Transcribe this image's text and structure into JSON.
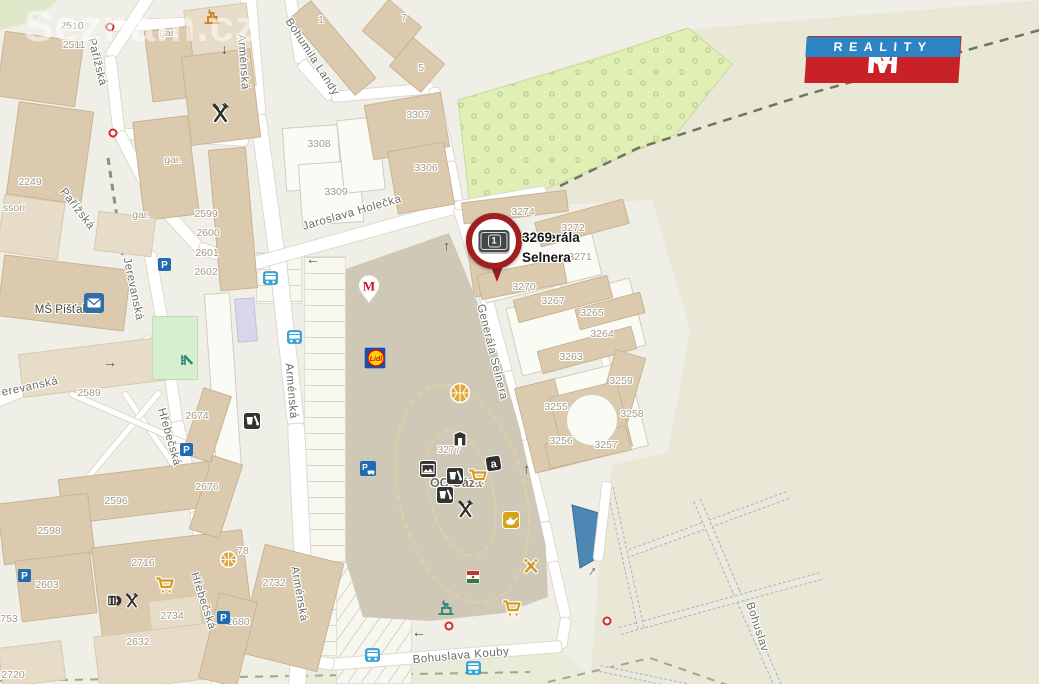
{
  "watermark": {
    "text": "Seznam.cz"
  },
  "logo": {
    "m1": "M",
    "amp": "&",
    "m2": "M",
    "reality": "REALITY"
  },
  "pin": {
    "badge": "1",
    "label_line1": "Generála Selnera",
    "label_line2": "3269"
  },
  "arrow_glyph": "→",
  "colors": {
    "base": "#f0efe7",
    "field": "#e9e8d7",
    "south_green": "#e9ecd9",
    "corner_green": "#dfe8c8",
    "orchard": "#e0efb4",
    "orchard_dot": "#b6ca8e",
    "pond": "#4d87b3",
    "accent_red": "#a11d20",
    "logo_red": "#c82127",
    "logo_blue": "#2d84c2",
    "bus_blue": "#36a7db",
    "parking_blue": "#1f6cb1",
    "cart_gold": "#d79b16"
  },
  "streets": [
    {
      "label": "Pařížská",
      "x": 97,
      "y": 62,
      "rot": 76
    },
    {
      "label": "Pařížská",
      "x": 77,
      "y": 209,
      "rot": 52
    },
    {
      "label": "Arménská",
      "x": 243,
      "y": 62,
      "rot": 86
    },
    {
      "label": "Arménská",
      "x": 291,
      "y": 391,
      "rot": 85
    },
    {
      "label": "Arménská",
      "x": 299,
      "y": 594,
      "rot": 80
    },
    {
      "label": "Bohumila Landy",
      "x": 312,
      "y": 57,
      "rot": 57
    },
    {
      "label": "Jaroslava Holečka",
      "x": 352,
      "y": 213,
      "rot": -16
    },
    {
      "label": "Jerevanská",
      "x": 133,
      "y": 289,
      "rot": 78
    },
    {
      "label": "erevanská",
      "x": 30,
      "y": 387,
      "rot": -12
    },
    {
      "label": "Hřebečská",
      "x": 169,
      "y": 437,
      "rot": 74
    },
    {
      "label": "Hřebečská",
      "x": 203,
      "y": 601,
      "rot": 72
    },
    {
      "label": "Generála Selnera",
      "x": 492,
      "y": 352,
      "rot": 76
    },
    {
      "label": "Bohuslava Kouby",
      "x": 461,
      "y": 656,
      "rot": -5
    },
    {
      "label": "Bohuslav",
      "x": 757,
      "y": 627,
      "rot": 72
    }
  ],
  "poi_labels": [
    {
      "label": "MŠ Píšťalka",
      "x": 66,
      "y": 310,
      "big": false
    },
    {
      "label": "OC Oáza",
      "x": 456,
      "y": 483,
      "big": true
    }
  ],
  "numbers": [
    {
      "t": "2510",
      "x": 72,
      "y": 26
    },
    {
      "t": "2511",
      "x": 74,
      "y": 45
    },
    {
      "t": "2249",
      "x": 30,
      "y": 182
    },
    {
      "t": "ssori",
      "x": 14,
      "y": 208
    },
    {
      "t": "gar.",
      "x": 168,
      "y": 33
    },
    {
      "t": "gar.",
      "x": 173,
      "y": 160
    },
    {
      "t": "gar.",
      "x": 141,
      "y": 215
    },
    {
      "t": "1",
      "x": 321,
      "y": 20
    },
    {
      "t": "7",
      "x": 404,
      "y": 18
    },
    {
      "t": "5",
      "x": 421,
      "y": 68
    },
    {
      "t": "3307",
      "x": 418,
      "y": 115
    },
    {
      "t": "3308",
      "x": 319,
      "y": 144
    },
    {
      "t": "3306",
      "x": 426,
      "y": 168
    },
    {
      "t": "3309",
      "x": 336,
      "y": 192
    },
    {
      "t": "2599",
      "x": 206,
      "y": 214
    },
    {
      "t": "2600",
      "x": 208,
      "y": 233
    },
    {
      "t": "2601",
      "x": 207,
      "y": 253
    },
    {
      "t": "2602",
      "x": 206,
      "y": 272
    },
    {
      "t": "3274",
      "x": 523,
      "y": 212
    },
    {
      "t": "3272",
      "x": 573,
      "y": 228
    },
    {
      "t": "3271",
      "x": 580,
      "y": 257
    },
    {
      "t": "3270",
      "x": 524,
      "y": 287
    },
    {
      "t": "3267",
      "x": 553,
      "y": 301
    },
    {
      "t": "3265",
      "x": 592,
      "y": 313
    },
    {
      "t": "3264",
      "x": 602,
      "y": 334
    },
    {
      "t": "3263",
      "x": 571,
      "y": 357
    },
    {
      "t": "3259",
      "x": 621,
      "y": 381
    },
    {
      "t": "3255",
      "x": 556,
      "y": 407
    },
    {
      "t": "3258",
      "x": 632,
      "y": 414
    },
    {
      "t": "3256",
      "x": 561,
      "y": 441
    },
    {
      "t": "3257",
      "x": 606,
      "y": 445
    },
    {
      "t": "3277",
      "x": 449,
      "y": 450
    },
    {
      "t": "2589",
      "x": 89,
      "y": 393
    },
    {
      "t": "2674",
      "x": 197,
      "y": 416
    },
    {
      "t": "2676",
      "x": 207,
      "y": 487
    },
    {
      "t": "2596",
      "x": 116,
      "y": 501
    },
    {
      "t": "2598",
      "x": 49,
      "y": 531
    },
    {
      "t": "2603",
      "x": 47,
      "y": 585
    },
    {
      "t": "2716",
      "x": 143,
      "y": 563
    },
    {
      "t": "78",
      "x": 243,
      "y": 551
    },
    {
      "t": "753",
      "x": 9,
      "y": 619
    },
    {
      "t": "2734",
      "x": 172,
      "y": 616
    },
    {
      "t": "2680",
      "x": 238,
      "y": 622
    },
    {
      "t": "2732",
      "x": 274,
      "y": 583
    },
    {
      "t": "2720",
      "x": 13,
      "y": 675
    },
    {
      "t": "2632",
      "x": 138,
      "y": 642
    }
  ],
  "roads": [
    [
      108,
      26,
      252,
      20,
      10
    ],
    [
      112,
      133,
      248,
      141,
      10
    ],
    [
      150,
      -6,
      110,
      56,
      11
    ],
    [
      110,
      56,
      119,
      132,
      11
    ],
    [
      119,
      132,
      152,
      196,
      11
    ],
    [
      152,
      196,
      199,
      247,
      11
    ],
    [
      199,
      247,
      258,
      268,
      11
    ],
    [
      248,
      -6,
      258,
      115,
      15
    ],
    [
      258,
      115,
      278,
      262,
      15
    ],
    [
      278,
      262,
      296,
      424,
      16
    ],
    [
      296,
      424,
      303,
      565,
      16
    ],
    [
      303,
      565,
      297,
      690,
      16
    ],
    [
      150,
      252,
      164,
      332,
      11
    ],
    [
      164,
      332,
      177,
      422,
      11
    ],
    [
      152,
      340,
      -4,
      402,
      10
    ],
    [
      177,
      422,
      196,
      512,
      12
    ],
    [
      196,
      512,
      211,
      602,
      12
    ],
    [
      211,
      602,
      219,
      690,
      12
    ],
    [
      290,
      -5,
      301,
      62,
      11
    ],
    [
      301,
      62,
      332,
      97,
      11
    ],
    [
      332,
      97,
      434,
      88,
      10
    ],
    [
      434,
      88,
      450,
      162,
      10
    ],
    [
      450,
      162,
      459,
      209,
      10
    ],
    [
      252,
      264,
      460,
      206,
      12
    ],
    [
      459,
      207,
      479,
      271,
      12
    ],
    [
      479,
      271,
      506,
      372,
      12
    ],
    [
      506,
      372,
      523,
      441,
      12
    ],
    [
      523,
      441,
      544,
      522,
      12
    ],
    [
      544,
      522,
      553,
      562,
      11
    ],
    [
      553,
      562,
      566,
      618,
      10
    ],
    [
      566,
      618,
      561,
      648,
      10
    ],
    [
      330,
      664,
      561,
      646,
      11
    ],
    [
      298,
      658,
      333,
      664,
      11
    ],
    [
      598,
      560,
      607,
      482,
      9
    ],
    [
      455,
      206,
      546,
      190,
      8
    ],
    [
      502,
      276,
      548,
      266,
      7
    ],
    [
      549,
      265,
      562,
      300,
      7
    ],
    [
      556,
      344,
      641,
      324,
      7
    ],
    [
      602,
      347,
      614,
      392,
      7
    ],
    [
      124,
      392,
      233,
      551,
      5
    ],
    [
      160,
      391,
      42,
      532,
      5
    ],
    [
      70,
      393,
      230,
      462,
      5
    ]
  ],
  "paths": [
    [
      630,
      553,
      788,
      495,
      8
    ],
    [
      697,
      500,
      736,
      591,
      8
    ],
    [
      736,
      591,
      778,
      686,
      8
    ],
    [
      620,
      631,
      821,
      576,
      8
    ],
    [
      610,
      487,
      641,
      628,
      7
    ],
    [
      600,
      668,
      686,
      686,
      7
    ]
  ],
  "dashes": [
    {
      "pts": [
        [
          560,
          186
        ],
        [
          638,
          148
        ],
        [
          808,
          94
        ],
        [
          1040,
          30
        ]
      ],
      "c": "#73735f",
      "w": 2.5,
      "da": "9,7"
    },
    {
      "pts": [
        [
          108,
          158
        ],
        [
          123,
          257
        ]
      ],
      "c": "#8e8e80",
      "w": 3,
      "da": "7,6"
    },
    {
      "pts": [
        [
          0,
          681
        ],
        [
          530,
          672
        ]
      ],
      "c": "#a3a687",
      "w": 2,
      "da": "8,7"
    },
    {
      "pts": [
        [
          548,
          682
        ],
        [
          650,
          658
        ],
        [
          730,
          686
        ]
      ],
      "c": "#a3a687",
      "w": 2,
      "da": "8,7"
    }
  ],
  "areas": {
    "field": [
      [
        455,
        102
      ],
      [
        680,
        30
      ],
      [
        1040,
        0
      ],
      [
        1040,
        686
      ],
      [
        590,
        686
      ],
      [
        600,
        550
      ],
      [
        612,
        465
      ],
      [
        668,
        452
      ],
      [
        690,
        330
      ],
      [
        652,
        200
      ],
      [
        560,
        205
      ]
    ],
    "south": [
      [
        298,
        668
      ],
      [
        560,
        648
      ],
      [
        602,
        686
      ],
      [
        298,
        686
      ]
    ],
    "corner": [
      [
        0,
        0
      ],
      [
        58,
        0
      ],
      [
        30,
        22
      ],
      [
        0,
        30
      ]
    ],
    "orchard": [
      [
        458,
        100
      ],
      [
        600,
        58
      ],
      [
        688,
        28
      ],
      [
        732,
        64
      ],
      [
        676,
        134
      ],
      [
        548,
        188
      ],
      [
        470,
        206
      ]
    ],
    "pond": [
      [
        572,
        505
      ],
      [
        599,
        513
      ],
      [
        601,
        556
      ],
      [
        580,
        568
      ]
    ]
  },
  "buildings": [
    [
      0,
      36,
      80,
      66,
      8,
      "t"
    ],
    [
      12,
      106,
      76,
      94,
      8,
      "t"
    ],
    [
      0,
      198,
      62,
      58,
      8,
      "t2"
    ],
    [
      188,
      6,
      64,
      84,
      -7,
      "t2"
    ],
    [
      148,
      28,
      46,
      72,
      -7,
      "t"
    ],
    [
      138,
      118,
      56,
      100,
      -7,
      "t"
    ],
    [
      186,
      52,
      70,
      90,
      -7,
      "t"
    ],
    [
      214,
      148,
      38,
      142,
      -5,
      "t"
    ],
    [
      0,
      262,
      128,
      62,
      7,
      "t"
    ],
    [
      20,
      345,
      150,
      44,
      -7,
      "t2"
    ],
    [
      96,
      214,
      58,
      40,
      7,
      "t2"
    ],
    [
      236,
      298,
      20,
      44,
      -5,
      "l"
    ],
    [
      210,
      293,
      26,
      178,
      -4,
      "w"
    ],
    [
      282,
      34,
      102,
      28,
      50,
      "t"
    ],
    [
      370,
      8,
      44,
      42,
      40,
      "t"
    ],
    [
      396,
      46,
      42,
      38,
      40,
      "t"
    ],
    [
      284,
      126,
      56,
      64,
      -4,
      "w"
    ],
    [
      300,
      162,
      62,
      62,
      -4,
      "w"
    ],
    [
      340,
      118,
      42,
      74,
      -6,
      "w"
    ],
    [
      368,
      98,
      78,
      56,
      -10,
      "t"
    ],
    [
      392,
      146,
      58,
      64,
      -10,
      "t"
    ],
    [
      478,
      238,
      120,
      52,
      -14,
      "w"
    ],
    [
      512,
      292,
      128,
      70,
      -14,
      "w"
    ],
    [
      532,
      372,
      108,
      88,
      -14,
      "w"
    ],
    [
      462,
      196,
      106,
      22,
      -7,
      "t"
    ],
    [
      536,
      210,
      92,
      26,
      -15,
      "t"
    ],
    [
      470,
      240,
      26,
      56,
      -8,
      "t"
    ],
    [
      478,
      266,
      88,
      26,
      -11,
      "t"
    ],
    [
      514,
      287,
      98,
      24,
      -15,
      "t"
    ],
    [
      576,
      300,
      68,
      22,
      -15,
      "t"
    ],
    [
      538,
      338,
      98,
      24,
      -15,
      "t"
    ],
    [
      602,
      352,
      32,
      94,
      16,
      "t"
    ],
    [
      524,
      382,
      42,
      88,
      -14,
      "t"
    ],
    [
      556,
      388,
      70,
      68,
      -14,
      "t"
    ],
    [
      546,
      434,
      84,
      26,
      -13,
      "t"
    ],
    [
      60,
      470,
      152,
      46,
      -7,
      "t"
    ],
    [
      0,
      498,
      92,
      62,
      -7,
      "t"
    ],
    [
      18,
      556,
      76,
      62,
      -7,
      "t"
    ],
    [
      96,
      538,
      152,
      92,
      -7,
      "t"
    ],
    [
      150,
      598,
      52,
      44,
      -7,
      "t2"
    ],
    [
      96,
      628,
      140,
      56,
      -7,
      "t2"
    ],
    [
      0,
      644,
      64,
      40,
      -7,
      "t2"
    ],
    [
      250,
      552,
      82,
      112,
      14,
      "t"
    ],
    [
      208,
      596,
      40,
      88,
      14,
      "t"
    ],
    [
      192,
      390,
      30,
      70,
      18,
      "t"
    ],
    [
      200,
      458,
      32,
      78,
      18,
      "t"
    ],
    [
      152,
      316,
      46,
      64,
      0,
      "g"
    ]
  ],
  "courtyard_circle": [
    592,
    420,
    26
  ],
  "parking": [
    [
      304,
      256,
      42,
      400,
      "h"
    ],
    [
      256,
      252,
      46,
      52,
      "h"
    ],
    [
      336,
      562,
      76,
      122,
      "d"
    ]
  ],
  "mall": {
    "x": 335,
    "y": 225,
    "w": 215,
    "h": 400,
    "poly": "5% 11%,53% 2%,60% 11%,77% 34%,86% 51%,98% 80%,99% 93%,79% 97%,44% 99%,13% 98%,5% 84%"
  },
  "ovals": [
    [
      398,
      382,
      128,
      224,
      -14
    ],
    [
      428,
      428,
      66,
      130,
      -14
    ]
  ],
  "icons": [
    {
      "type": "factory-icon",
      "x": 203,
      "y": 8,
      "c": "#d07f2a"
    },
    {
      "type": "restaurant-icon",
      "x": 210,
      "y": 103,
      "s": 21
    },
    {
      "type": "school-icon",
      "x": 84,
      "y": 293
    },
    {
      "type": "parking-icon",
      "x": 158,
      "y": 258,
      "glyph": "P"
    },
    {
      "type": "parking-icon",
      "x": 180,
      "y": 443,
      "glyph": "P"
    },
    {
      "type": "parking-icon",
      "x": 18,
      "y": 569,
      "glyph": "P"
    },
    {
      "type": "parking-icon",
      "x": 217,
      "y": 611,
      "glyph": "P"
    },
    {
      "type": "parking-car-icon",
      "x": 360,
      "y": 461,
      "glyph": "P"
    },
    {
      "type": "bus-stop-icon",
      "x": 263,
      "y": 271
    },
    {
      "type": "bus-stop-icon",
      "x": 287,
      "y": 330
    },
    {
      "type": "bus-stop-icon",
      "x": 365,
      "y": 648
    },
    {
      "type": "bus-stop-icon",
      "x": 466,
      "y": 661
    },
    {
      "type": "slide-icon",
      "x": 176,
      "y": 351
    },
    {
      "type": "lidl-icon",
      "x": 364,
      "y": 347,
      "glyph": "Lidl"
    },
    {
      "type": "mcdonalds-pin-icon",
      "x": 357,
      "y": 274,
      "glyph": "M"
    },
    {
      "type": "refreshment-icon",
      "x": 243,
      "y": 412
    },
    {
      "type": "refreshment-icon",
      "x": 446,
      "y": 467
    },
    {
      "type": "refreshment-icon",
      "x": 436,
      "y": 486
    },
    {
      "type": "cart-icon",
      "x": 468,
      "y": 467
    },
    {
      "type": "cart-icon",
      "x": 155,
      "y": 575
    },
    {
      "type": "cart-icon",
      "x": 502,
      "y": 598
    },
    {
      "type": "letter-a-icon",
      "x": 485,
      "y": 455,
      "glyph": "a"
    },
    {
      "type": "gallery-icon",
      "x": 419,
      "y": 460
    },
    {
      "type": "shop-door-icon",
      "x": 451,
      "y": 430
    },
    {
      "type": "restaurant-icon",
      "x": 456,
      "y": 500,
      "s": 19
    },
    {
      "type": "lamp-icon",
      "x": 502,
      "y": 511
    },
    {
      "type": "sport-court-icon",
      "x": 449,
      "y": 382,
      "s": 22
    },
    {
      "type": "sport-court-icon",
      "x": 219,
      "y": 550,
      "s": 19
    },
    {
      "type": "tools-icon",
      "x": 521,
      "y": 556
    },
    {
      "type": "shop-striped-icon",
      "x": 466,
      "y": 570
    },
    {
      "type": "beer-icon",
      "x": 104,
      "y": 591
    },
    {
      "type": "restaurant-icon",
      "x": 124,
      "y": 593,
      "s": 16
    },
    {
      "type": "factory-icon",
      "x": 437,
      "y": 599,
      "c": "#2e8a74"
    }
  ],
  "arrows": [
    {
      "x": 227,
      "y": 50,
      "rot": 90
    },
    {
      "x": 110,
      "y": 362,
      "rot": 0
    },
    {
      "x": 313,
      "y": 264,
      "rot": 180
    },
    {
      "x": 444,
      "y": 247,
      "rot": -90
    },
    {
      "x": 524,
      "y": 470,
      "rot": -90
    },
    {
      "x": 590,
      "y": 570,
      "rot": -55
    },
    {
      "x": 419,
      "y": 637,
      "rot": 180
    }
  ],
  "gates": [
    [
      110,
      27
    ],
    [
      113,
      133
    ],
    [
      449,
      626
    ],
    [
      607,
      621
    ]
  ]
}
